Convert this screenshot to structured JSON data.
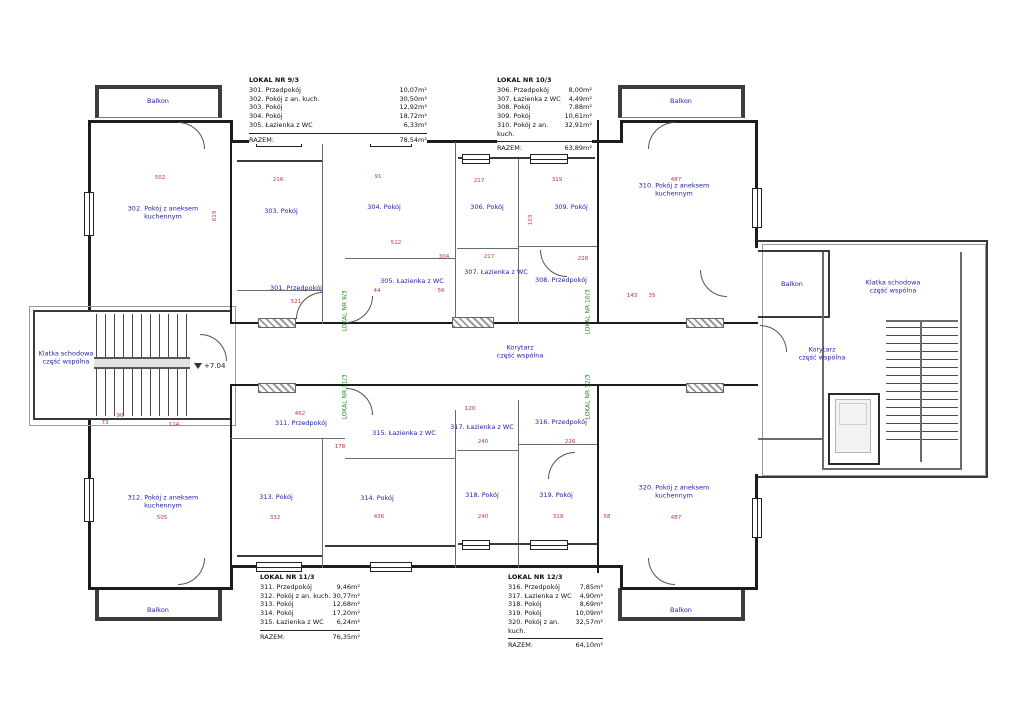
{
  "colors": {
    "room_label": "#2121cc",
    "dimension": "#cc3434",
    "lokal_marker": "#1e8c1e",
    "wall": "#1c1c1c"
  },
  "labels": {
    "razem": "RAZEM:"
  },
  "legends": [
    {
      "title": "LOKAL NR 9/3",
      "rows": [
        [
          "301. Przedpokój",
          "10,07m²"
        ],
        [
          "302. Pokój z an. kuch.",
          "30,50m²"
        ],
        [
          "303. Pokój",
          "12,92m²"
        ],
        [
          "304. Pokój",
          "18,72m²"
        ],
        [
          "305. Łazienka z WC",
          "6,33m²"
        ]
      ],
      "razem": "78,54m²"
    },
    {
      "title": "LOKAL NR 10/3",
      "rows": [
        [
          "306. Przedpokój",
          "8,00m²"
        ],
        [
          "307. Łazienka z WC",
          "4,49m²"
        ],
        [
          "308. Pokój",
          "7,88m²"
        ],
        [
          "309. Pokój",
          "10,61m²"
        ],
        [
          "310. Pokój z an. kuch.",
          "32,91m²"
        ]
      ],
      "razem": "63,89m²"
    },
    {
      "title": "LOKAL NR 11/3",
      "rows": [
        [
          "311. Przedpokój",
          "9,46m²"
        ],
        [
          "312. Pokój z an. kuch.",
          "30,77m²"
        ],
        [
          "313. Pokój",
          "12,68m²"
        ],
        [
          "314. Pokój",
          "17,20m²"
        ],
        [
          "315. Łazienka z WC",
          "6,24m²"
        ]
      ],
      "razem": "76,35m²"
    },
    {
      "title": "LOKAL NR 12/3",
      "rows": [
        [
          "316. Przedpokój",
          "7,85m²"
        ],
        [
          "317. Łazienka z WC",
          "4,90m²"
        ],
        [
          "318. Pokój",
          "8,69m²"
        ],
        [
          "319. Pokój",
          "10,09m²"
        ],
        [
          "320. Pokój z an. kuch.",
          "32,57m²"
        ]
      ],
      "razem": "64,10m²"
    }
  ],
  "rooms": [
    {
      "label": "Balkon",
      "x": 158,
      "y": 101
    },
    {
      "label": "Balkon",
      "x": 681,
      "y": 101
    },
    {
      "label": "Balkon",
      "x": 158,
      "y": 610
    },
    {
      "label": "Balkon",
      "x": 681,
      "y": 610
    },
    {
      "label": "Balkon",
      "x": 792,
      "y": 284
    },
    {
      "label": "Klatka schodowa\nczęść wspólna",
      "x": 66,
      "y": 358
    },
    {
      "label": "Klatka schodowa\nczęść wspólna",
      "x": 893,
      "y": 287
    },
    {
      "label": "Korytarz\nczęść wspólna",
      "x": 520,
      "y": 352
    },
    {
      "label": "Korytarz\nczęść wspólna",
      "x": 822,
      "y": 354
    },
    {
      "label": "301. Przedpokój",
      "x": 296,
      "y": 288
    },
    {
      "label": "302. Pokój z aneksem\nkuchennym",
      "x": 163,
      "y": 213
    },
    {
      "label": "303. Pokój",
      "x": 281,
      "y": 211
    },
    {
      "label": "304. Pokój",
      "x": 384,
      "y": 207
    },
    {
      "label": "305. Łazienka z WC",
      "x": 412,
      "y": 281
    },
    {
      "label": "306. Pokój",
      "x": 487,
      "y": 207
    },
    {
      "label": "307. Łazienka z WC",
      "x": 496,
      "y": 272
    },
    {
      "label": "308. Przedpokój",
      "x": 561,
      "y": 280
    },
    {
      "label": "309. Pokój",
      "x": 571,
      "y": 207
    },
    {
      "label": "310. Pokój z aneksem\nkuchennym",
      "x": 674,
      "y": 190
    },
    {
      "label": "311. Przedpokój",
      "x": 301,
      "y": 423
    },
    {
      "label": "312. Pokój z aneksem\nkuchennym",
      "x": 163,
      "y": 502
    },
    {
      "label": "313. Pokój",
      "x": 276,
      "y": 497
    },
    {
      "label": "314. Pokój",
      "x": 377,
      "y": 498
    },
    {
      "label": "315. Łazienka z WC",
      "x": 404,
      "y": 433
    },
    {
      "label": "316. Przedpokój",
      "x": 561,
      "y": 422
    },
    {
      "label": "317. Łazienka z WC",
      "x": 482,
      "y": 427
    },
    {
      "label": "318. Pokój",
      "x": 482,
      "y": 495
    },
    {
      "label": "319. Pokój",
      "x": 556,
      "y": 495
    },
    {
      "label": "320. Pokój z aneksem\nkuchennym",
      "x": 674,
      "y": 492
    }
  ],
  "lokal_markers": [
    {
      "label": "LOKAL NR 9/3",
      "x": 345,
      "y": 311
    },
    {
      "label": "LOKAL NR 10/3",
      "x": 588,
      "y": 312
    },
    {
      "label": "LOKAL NR 11/3",
      "x": 345,
      "y": 397
    },
    {
      "label": "LOKAL NR 12/3",
      "x": 588,
      "y": 397
    }
  ],
  "dimensions": [
    {
      "t": "502",
      "x": 160,
      "y": 178
    },
    {
      "t": "216",
      "x": 278,
      "y": 180
    },
    {
      "t": "91",
      "x": 378,
      "y": 177
    },
    {
      "t": "217",
      "x": 479,
      "y": 181
    },
    {
      "t": "319",
      "x": 557,
      "y": 180
    },
    {
      "t": "487",
      "x": 676,
      "y": 180
    },
    {
      "t": "619",
      "x": 215,
      "y": 216,
      "v": true
    },
    {
      "t": "103",
      "x": 531,
      "y": 220,
      "v": true
    },
    {
      "t": "512",
      "x": 396,
      "y": 243
    },
    {
      "t": "304",
      "x": 444,
      "y": 257
    },
    {
      "t": "217",
      "x": 489,
      "y": 257
    },
    {
      "t": "228",
      "x": 583,
      "y": 259
    },
    {
      "t": "44",
      "x": 377,
      "y": 291
    },
    {
      "t": "56",
      "x": 441,
      "y": 291
    },
    {
      "t": "521",
      "x": 296,
      "y": 302
    },
    {
      "t": "143",
      "x": 632,
      "y": 296
    },
    {
      "t": "35",
      "x": 652,
      "y": 296
    },
    {
      "t": "73",
      "x": 105,
      "y": 423
    },
    {
      "t": "90",
      "x": 120,
      "y": 416
    },
    {
      "t": "114",
      "x": 174,
      "y": 425
    },
    {
      "t": "462",
      "x": 300,
      "y": 414
    },
    {
      "t": "178",
      "x": 340,
      "y": 447
    },
    {
      "t": "120",
      "x": 470,
      "y": 409
    },
    {
      "t": "240",
      "x": 483,
      "y": 442
    },
    {
      "t": "226",
      "x": 570,
      "y": 442
    },
    {
      "t": "505",
      "x": 162,
      "y": 518
    },
    {
      "t": "332",
      "x": 275,
      "y": 518
    },
    {
      "t": "436",
      "x": 379,
      "y": 517
    },
    {
      "t": "240",
      "x": 483,
      "y": 517
    },
    {
      "t": "319",
      "x": 558,
      "y": 517
    },
    {
      "t": "58",
      "x": 607,
      "y": 517
    },
    {
      "t": "487",
      "x": 676,
      "y": 518
    }
  ],
  "elevation": {
    "label": "+7.04"
  }
}
